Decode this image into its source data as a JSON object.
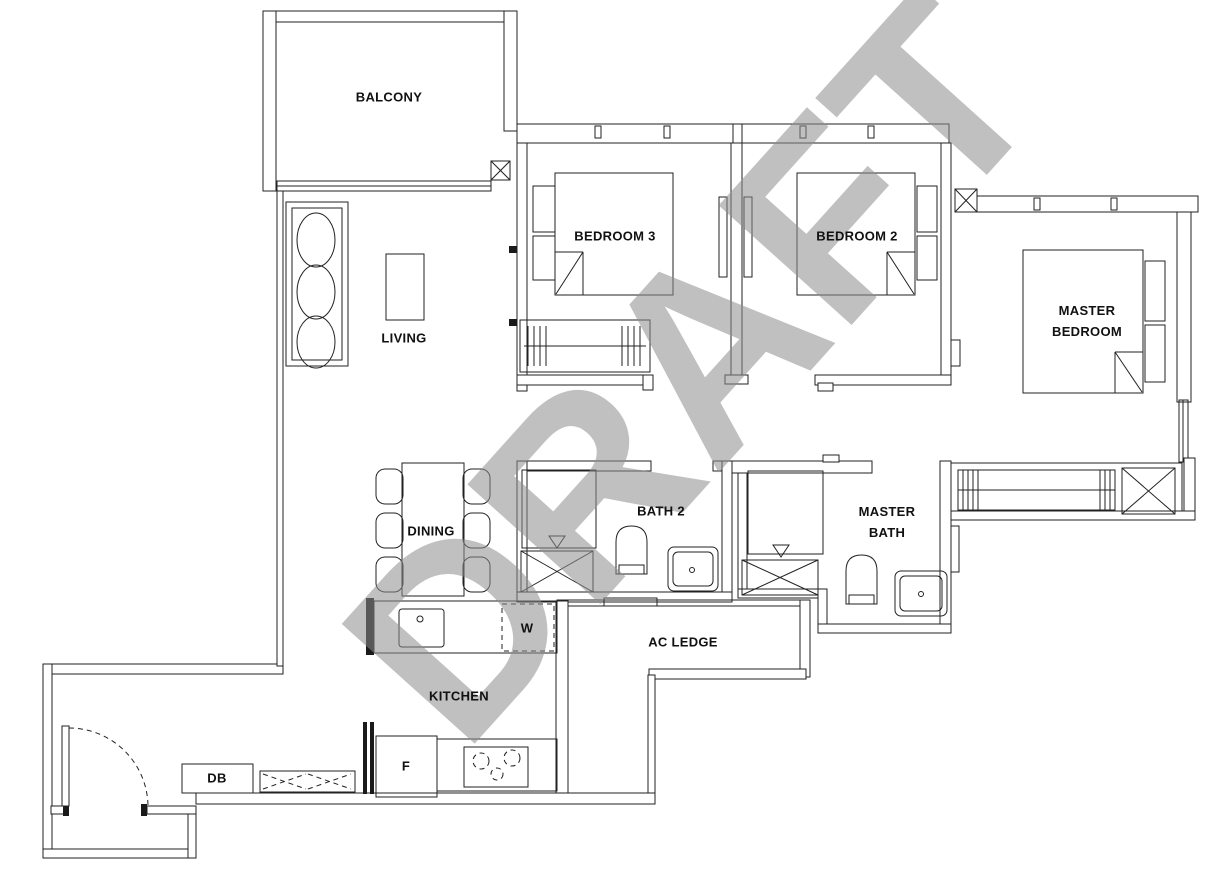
{
  "title": "3-bedroom apartment floor plan (draft)",
  "watermark": {
    "text": "DRAFT",
    "color": "#c0c0c0"
  },
  "palette": {
    "line": "#222222",
    "background": "#ffffff",
    "label": "#111111"
  },
  "rooms": {
    "balcony": {
      "label": "BALCONY"
    },
    "living": {
      "label": "LIVING"
    },
    "dining": {
      "label": "DINING"
    },
    "kitchen": {
      "label": "KITCHEN"
    },
    "bedroom3": {
      "label": "BEDROOM 3"
    },
    "bedroom2": {
      "label": "BEDROOM 2"
    },
    "master_bedroom": {
      "line1": "MASTER",
      "line2": "BEDROOM"
    },
    "bath2": {
      "label": "BATH 2"
    },
    "master_bath": {
      "line1": "MASTER",
      "line2": "BATH"
    },
    "ac_ledge": {
      "label": "AC LEDGE"
    }
  },
  "fixtures": {
    "washer": {
      "label": "W"
    },
    "fridge": {
      "label": "F"
    },
    "db": {
      "label": "DB"
    }
  }
}
